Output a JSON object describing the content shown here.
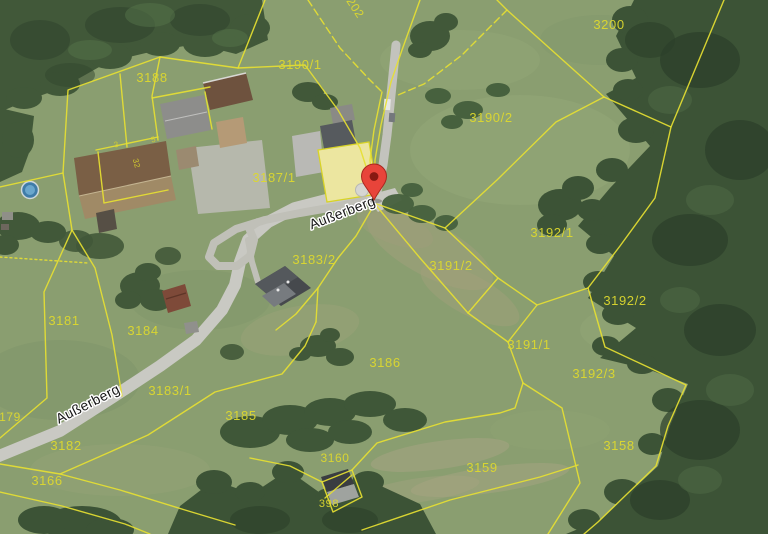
{
  "app": {
    "type": "aerial-cadastral-map-view"
  },
  "colors": {
    "boundary_line": "#e6e032",
    "parcel_label": "#ddd82f",
    "street_label_fill": "#161616",
    "street_label_halo": "#ffffff",
    "marker_red": "#e8443a",
    "marker_dot": "#871912",
    "field_green": "#8a9e70",
    "forest_green": "#3c5336",
    "road_gray": "#c9c9c3"
  },
  "marker": {
    "name": "location-pin",
    "x": 374,
    "y": 200
  },
  "street_labels": [
    {
      "text": "Außerberg",
      "x": 344,
      "y": 217,
      "rotation": -21
    },
    {
      "text": "Außerberg",
      "x": 90,
      "y": 408,
      "rotation": -27
    }
  ],
  "parcel_labels": [
    {
      "text": "202",
      "x": 352,
      "y": 10,
      "rotation": 57,
      "size": 12
    },
    {
      "text": "3200",
      "x": 609,
      "y": 29,
      "size": 13
    },
    {
      "text": "3190/1",
      "x": 300,
      "y": 69,
      "size": 13
    },
    {
      "text": "3188",
      "x": 152,
      "y": 82,
      "size": 13
    },
    {
      "text": "3190/2",
      "x": 491,
      "y": 122,
      "size": 13
    },
    {
      "text": "3187/1",
      "x": 274,
      "y": 182,
      "size": 13
    },
    {
      "text": "3192/1",
      "x": 552,
      "y": 237,
      "size": 13
    },
    {
      "text": "3183/2",
      "x": 314,
      "y": 264,
      "size": 13
    },
    {
      "text": "3191/2",
      "x": 451,
      "y": 270,
      "size": 13
    },
    {
      "text": "3192/2",
      "x": 625,
      "y": 305,
      "size": 13
    },
    {
      "text": "3181",
      "x": 64,
      "y": 325,
      "size": 13
    },
    {
      "text": "3184",
      "x": 143,
      "y": 335,
      "size": 13
    },
    {
      "text": "3191/1",
      "x": 529,
      "y": 349,
      "size": 13
    },
    {
      "text": "3186",
      "x": 385,
      "y": 367,
      "size": 13
    },
    {
      "text": "3192/3",
      "x": 594,
      "y": 378,
      "size": 13
    },
    {
      "text": "3183/1",
      "x": 170,
      "y": 395,
      "size": 13
    },
    {
      "text": "3185",
      "x": 241,
      "y": 420,
      "size": 13
    },
    {
      "text": "179",
      "x": 10,
      "y": 421,
      "size": 12
    },
    {
      "text": "3182",
      "x": 66,
      "y": 450,
      "size": 13
    },
    {
      "text": "3158",
      "x": 619,
      "y": 450,
      "size": 13
    },
    {
      "text": "3160",
      "x": 335,
      "y": 462,
      "size": 12
    },
    {
      "text": "3159",
      "x": 482,
      "y": 472,
      "size": 13
    },
    {
      "text": "3166",
      "x": 47,
      "y": 485,
      "size": 13
    },
    {
      "text": "398",
      "x": 329,
      "y": 507,
      "size": 11
    },
    {
      "text": "3",
      "x": 117,
      "y": 147,
      "rotation": -15,
      "size": 8,
      "tiny": true
    },
    {
      "text": "5",
      "x": 154,
      "y": 142,
      "rotation": -15,
      "size": 8,
      "tiny": true
    },
    {
      "text": "32",
      "x": 134,
      "y": 164,
      "rotation": 75,
      "size": 8,
      "tiny": true
    }
  ]
}
